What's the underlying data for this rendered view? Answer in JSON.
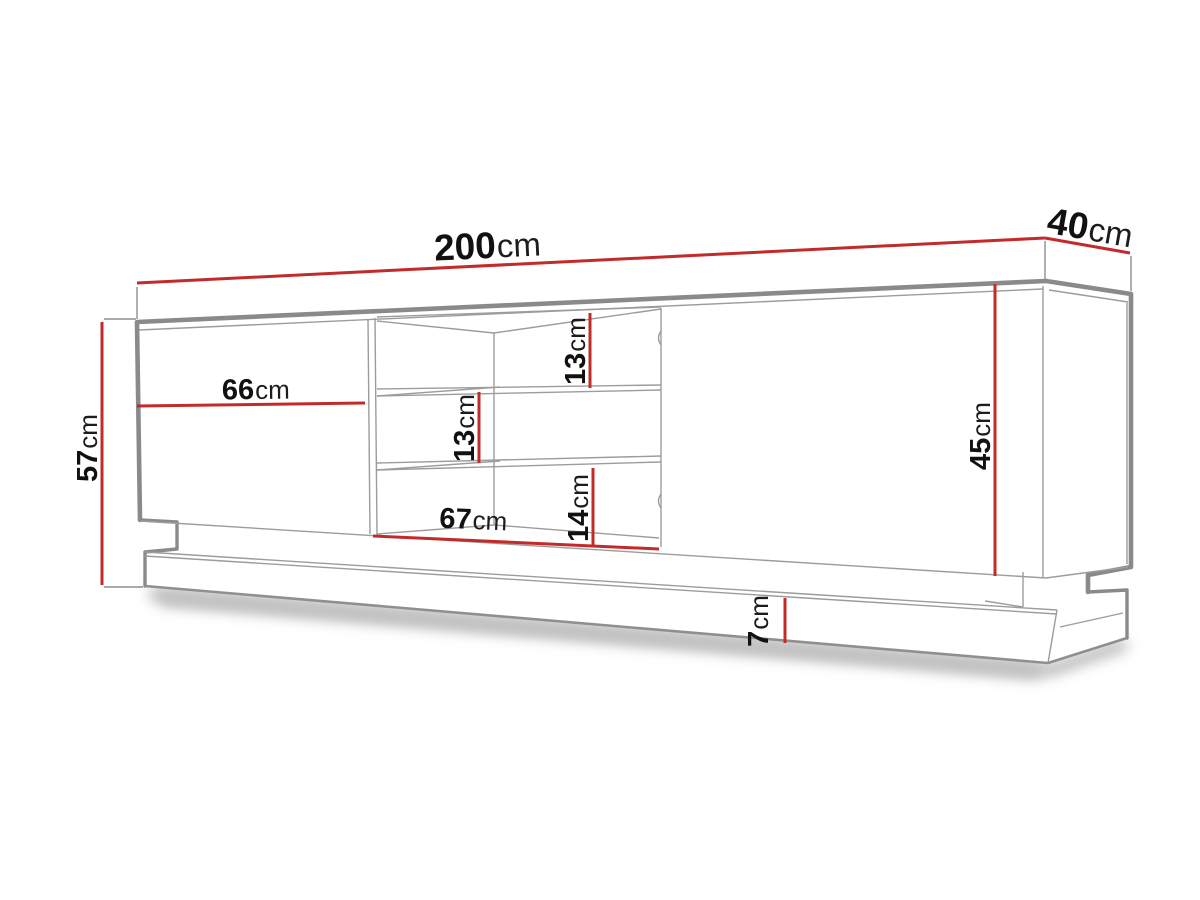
{
  "diagram": {
    "kind": "furniture-dimension-drawing",
    "subject": "TV stand / sideboard with open middle shelves and recessed plinth",
    "unit": "cm",
    "colors": {
      "dimension_line": "#c32b2b",
      "outline": "#8a8a8a",
      "background": "#ffffff",
      "label_text": "#111111"
    },
    "dimensions": {
      "width": {
        "value": "200",
        "unit": "cm",
        "meaning": "total width"
      },
      "depth": {
        "value": "40",
        "unit": "cm",
        "meaning": "total depth"
      },
      "total_height": {
        "value": "57",
        "unit": "cm",
        "meaning": "total height"
      },
      "front_height": {
        "value": "45",
        "unit": "cm",
        "meaning": "front panel height"
      },
      "left_door_width": {
        "value": "66",
        "unit": "cm",
        "meaning": "left door width"
      },
      "middle_width": {
        "value": "67",
        "unit": "cm",
        "meaning": "open middle section width"
      },
      "shelf_top": {
        "value": "13",
        "unit": "cm",
        "meaning": "top shelf opening height"
      },
      "shelf_middle": {
        "value": "13",
        "unit": "cm",
        "meaning": "middle shelf opening height"
      },
      "shelf_bottom": {
        "value": "14",
        "unit": "cm",
        "meaning": "bottom shelf opening height"
      },
      "plinth_height": {
        "value": "7",
        "unit": "cm",
        "meaning": "plinth / base height"
      }
    }
  }
}
